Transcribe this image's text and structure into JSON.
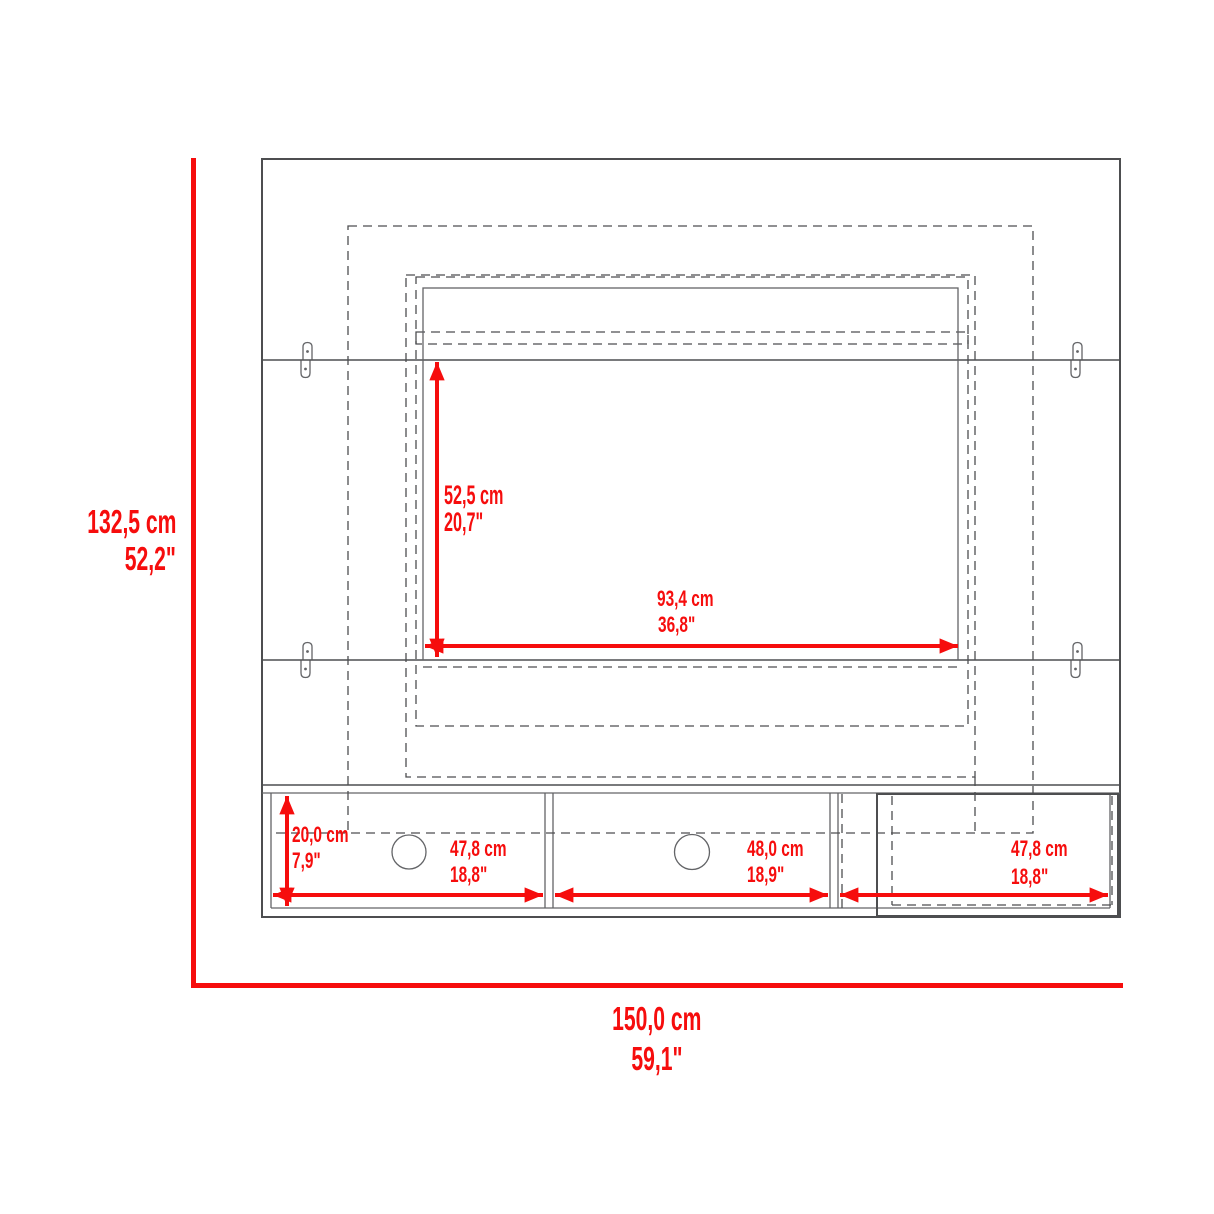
{
  "colors": {
    "dimension_red": "#f60d0d",
    "outline_dark": "#4d4e50",
    "outline_mid": "#636467",
    "background": "#ffffff"
  },
  "diagram": {
    "type": "furniture-dimension-diagram",
    "subject": "wall-mounted TV panel with shelf console",
    "overall": {
      "height": {
        "cm": "132,5 cm",
        "inches": "52,2\""
      },
      "width": {
        "cm": "150,0 cm",
        "inches": "59,1\""
      }
    },
    "tv_area": {
      "height": {
        "cm": "52,5 cm",
        "inches": "20,7\""
      },
      "width": {
        "cm": "93,4 cm",
        "inches": "36,8\""
      }
    },
    "console": {
      "shelf_height": {
        "cm": "20,0 cm",
        "inches": "7,9\""
      },
      "left_compartment_width": {
        "cm": "47,8 cm",
        "inches": "18,8\""
      },
      "middle_compartment_width": {
        "cm": "48,0 cm",
        "inches": "18,9\""
      },
      "right_compartment_width": {
        "cm": "47,8 cm",
        "inches": "18,8\""
      }
    }
  }
}
